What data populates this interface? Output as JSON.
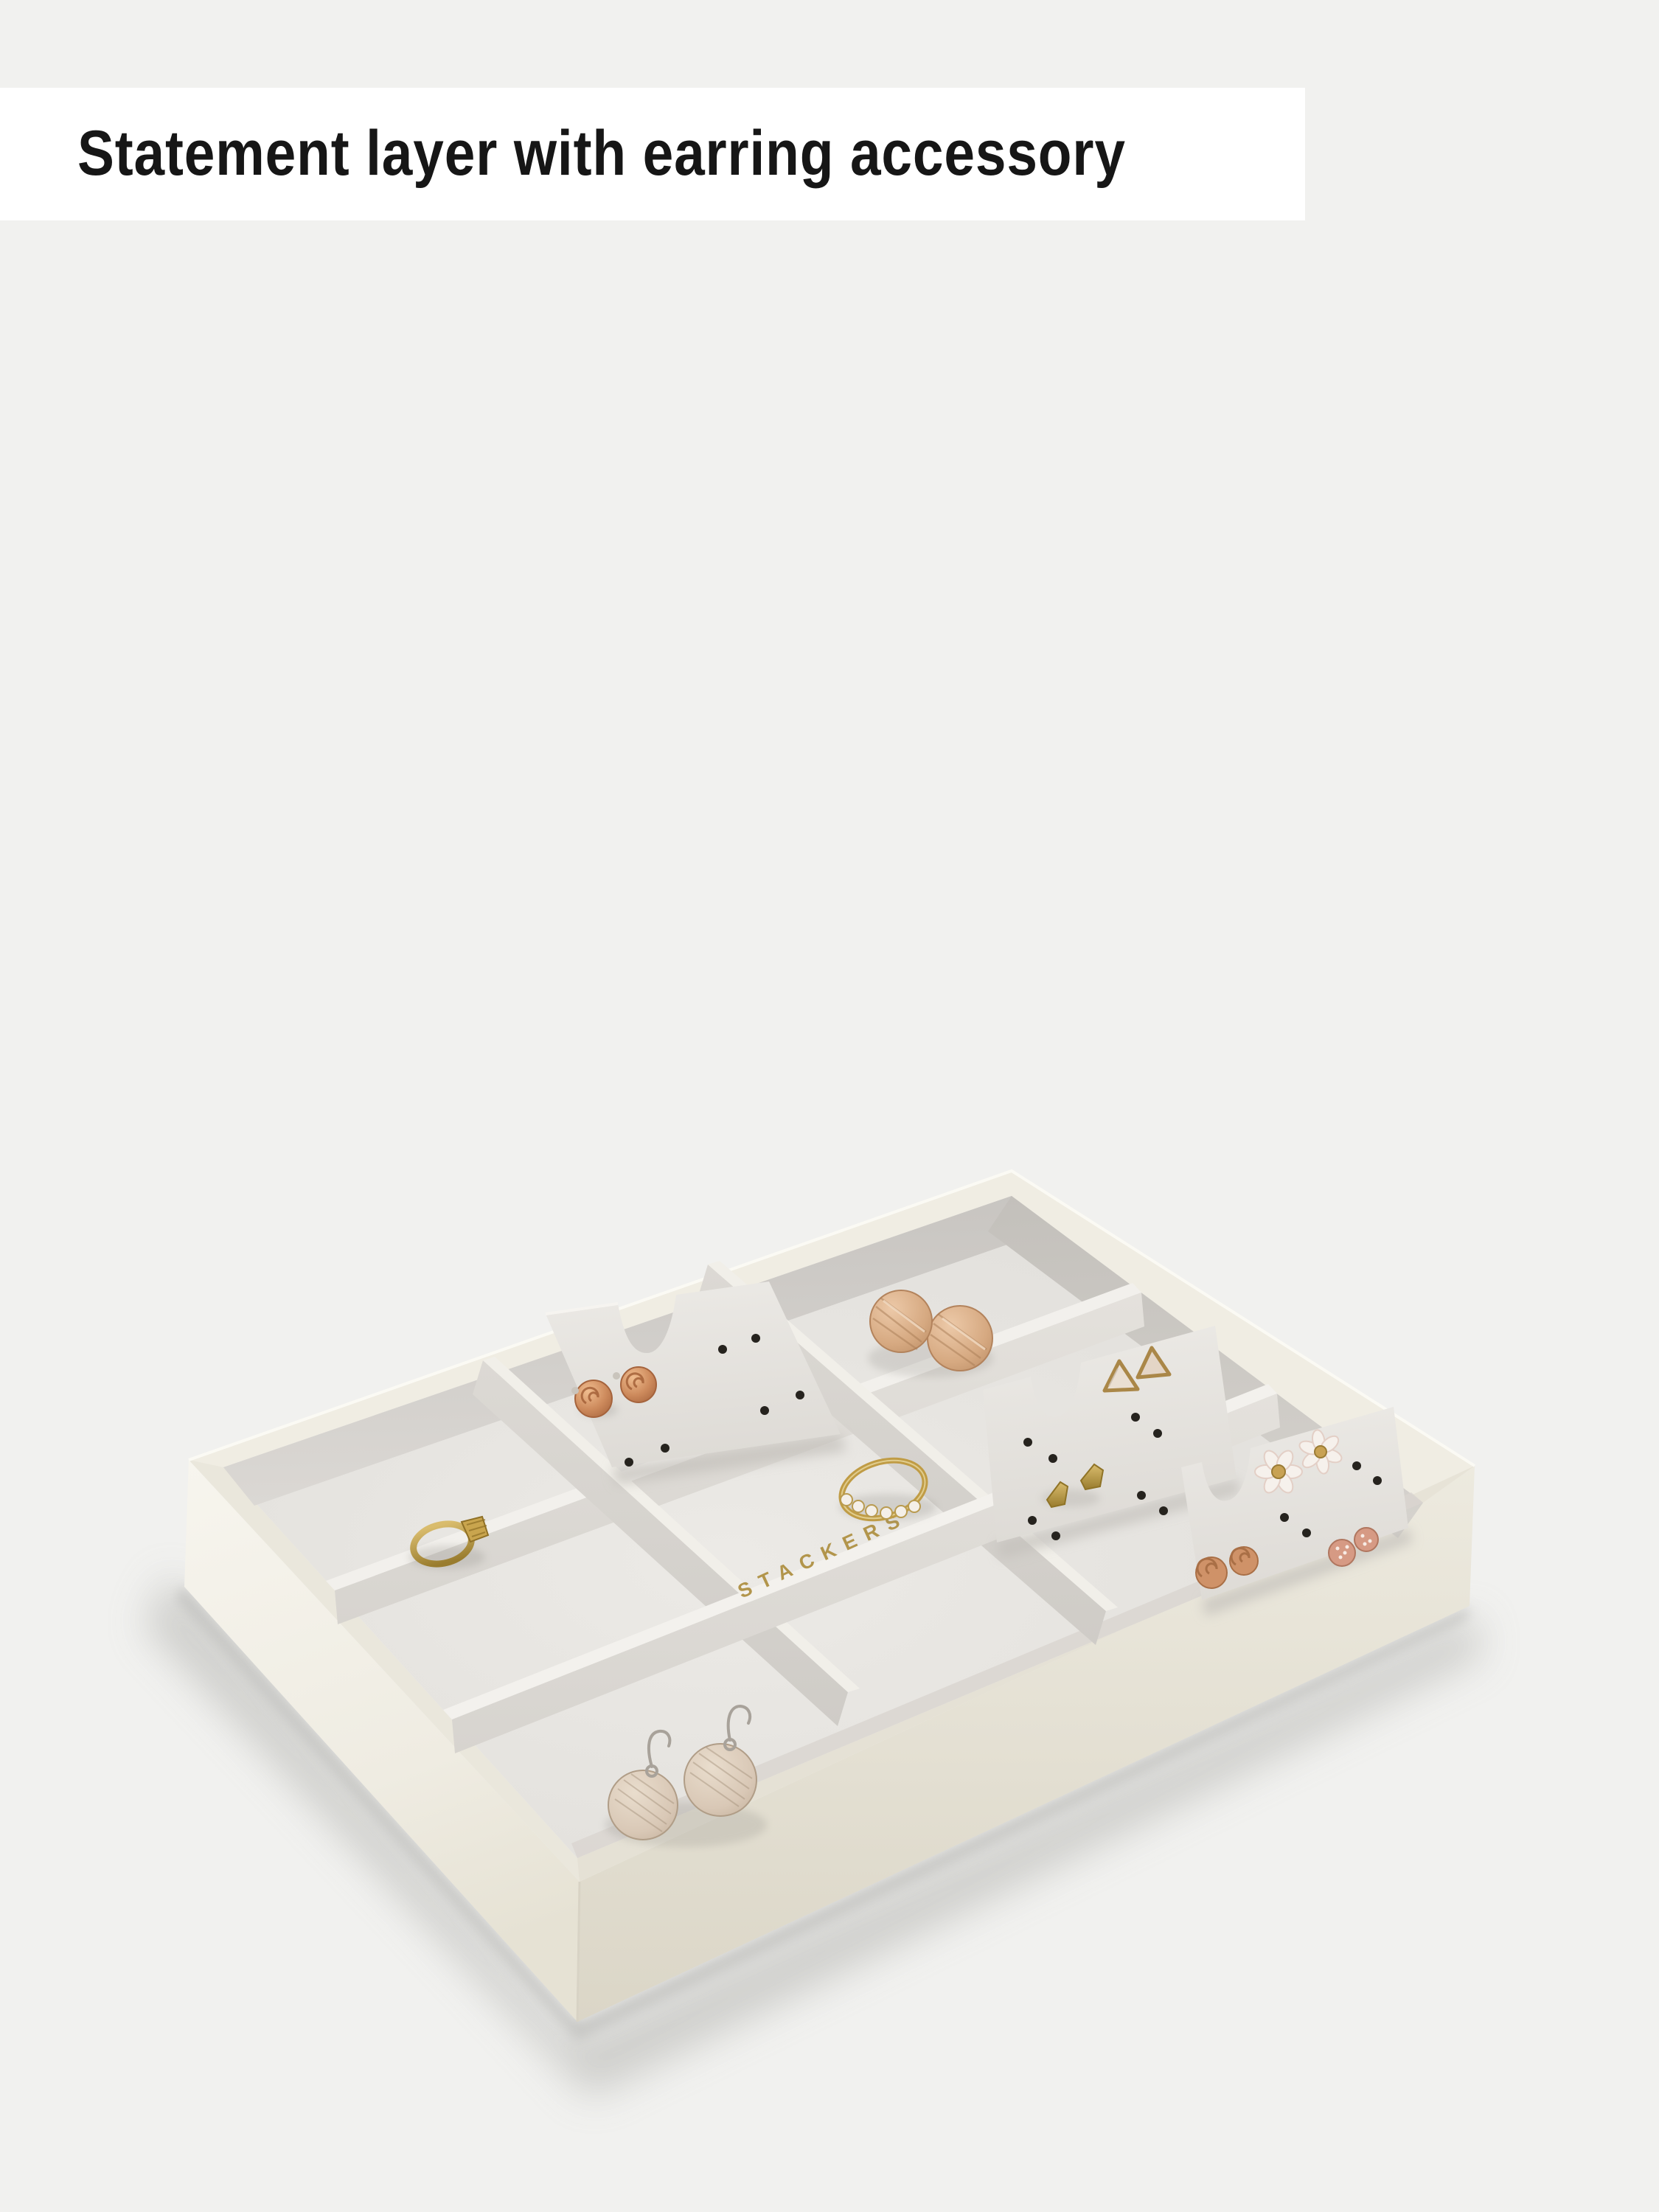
{
  "banner": {
    "title": "Statement layer with earring accessory",
    "background": "#ffffff",
    "text_color": "#161616"
  },
  "photo": {
    "background": "#f1f1ef",
    "logo_text": "STACKERS",
    "logo_color": "#b2954b",
    "tray": {
      "shell_color": "#eae7dc",
      "lining_color": "#e6e4e0",
      "compartments": 9,
      "earring_cards": 3
    },
    "jewelry": [
      {
        "name": "rose-stud-earrings",
        "color": "#cd8a5c"
      },
      {
        "name": "brushed-disc-earrings",
        "color": "#d6a981"
      },
      {
        "name": "triangle-stud-earrings",
        "color": "#aa8748"
      },
      {
        "name": "geometric-gold-studs",
        "color": "#b7953f"
      },
      {
        "name": "daisy-stud-earrings",
        "color": "#f6f1ec"
      },
      {
        "name": "knot-stud-earrings",
        "color": "#cf9268"
      },
      {
        "name": "pave-ball-studs",
        "color": "#d69a84"
      },
      {
        "name": "signet-ring",
        "color": "#bd9b42"
      },
      {
        "name": "crystal-band-ring",
        "color": "#c09c45"
      },
      {
        "name": "drop-disc-earrings",
        "color": "#d9c8b6"
      }
    ]
  }
}
